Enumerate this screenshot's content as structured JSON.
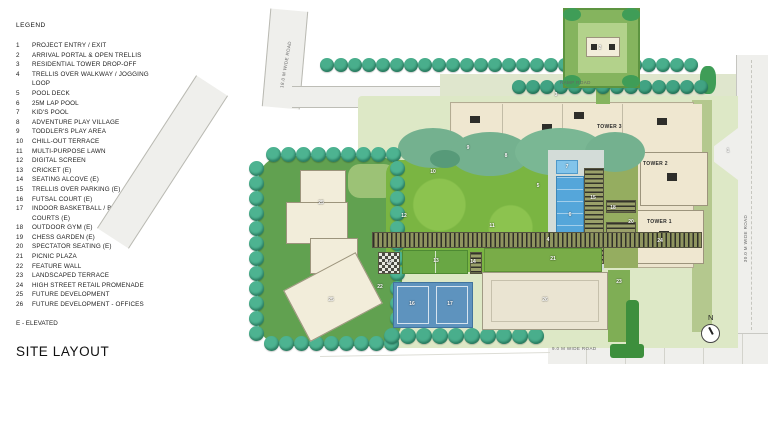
{
  "legend": {
    "title": "LEGEND",
    "items": [
      {
        "num": "1",
        "label": "PROJECT ENTRY / EXIT"
      },
      {
        "num": "2",
        "label": "ARRIVAL PORTAL & OPEN TRELLIS"
      },
      {
        "num": "3",
        "label": "RESIDENTIAL TOWER DROP-OFF"
      },
      {
        "num": "4",
        "label": "TRELLIS OVER WALKWAY / JOGGING LOOP"
      },
      {
        "num": "5",
        "label": "POOL DECK"
      },
      {
        "num": "6",
        "label": "25M LAP POOL"
      },
      {
        "num": "7",
        "label": "KID'S POOL"
      },
      {
        "num": "8",
        "label": "ADVENTURE PLAY VILLAGE"
      },
      {
        "num": "9",
        "label": "TODDLER'S PLAY AREA"
      },
      {
        "num": "10",
        "label": "CHILL-OUT TERRACE"
      },
      {
        "num": "11",
        "label": "MULTI-PURPOSE LAWN"
      },
      {
        "num": "12",
        "label": "DIGITAL SCREEN"
      },
      {
        "num": "13",
        "label": "CRICKET (E)"
      },
      {
        "num": "14",
        "label": "SEATING ALCOVE (E)"
      },
      {
        "num": "15",
        "label": "TRELLIS OVER PARKING (E)"
      },
      {
        "num": "16",
        "label": "FUTSAL COURT (E)"
      },
      {
        "num": "17",
        "label": "INDOOR BASKETBALL / BADMINTON COURTS (E)"
      },
      {
        "num": "18",
        "label": "OUTDOOR GYM (E)"
      },
      {
        "num": "19",
        "label": "CHESS GARDEN (E)"
      },
      {
        "num": "20",
        "label": "SPECTATOR SEATING (E)"
      },
      {
        "num": "21",
        "label": "PICNIC PLAZA"
      },
      {
        "num": "22",
        "label": "FEATURE WALL"
      },
      {
        "num": "23",
        "label": "LANDSCAPED TERRACE"
      },
      {
        "num": "24",
        "label": "HIGH STREET RETAIL PROMENADE"
      },
      {
        "num": "25",
        "label": "FUTURE DEVELOPMENT"
      },
      {
        "num": "26",
        "label": "FUTURE DEVELOPMENT - OFFICES"
      }
    ],
    "note": "E - ELEVATED"
  },
  "page_title": "SITE LAYOUT",
  "map": {
    "north_label": "N",
    "tower_labels": [
      {
        "text": "TOWER 3",
        "x": 597,
        "y": 124
      },
      {
        "text": "TOWER 2",
        "x": 643,
        "y": 161
      },
      {
        "text": "TOWER 1",
        "x": 647,
        "y": 219
      }
    ],
    "road_labels": [
      {
        "text": "18.0 M WIDE ROAD",
        "x": 262,
        "y": 62,
        "rot": -80
      },
      {
        "text": "RAMP ROAD",
        "x": 560,
        "y": 80,
        "rot": 0
      },
      {
        "text": "30.0 M WIDE ROAD",
        "x": 722,
        "y": 236,
        "rot": -90
      },
      {
        "text": "9.0 M WIDE ROAD",
        "x": 552,
        "y": 346,
        "rot": 0
      }
    ],
    "markers": [
      {
        "n": "1",
        "x": 728,
        "y": 151
      },
      {
        "n": "2",
        "x": 600,
        "y": 48
      },
      {
        "n": "3",
        "x": 556,
        "y": 95
      },
      {
        "n": "4",
        "x": 548,
        "y": 240
      },
      {
        "n": "5",
        "x": 538,
        "y": 186
      },
      {
        "n": "6",
        "x": 570,
        "y": 215
      },
      {
        "n": "7",
        "x": 567,
        "y": 167
      },
      {
        "n": "8",
        "x": 506,
        "y": 156
      },
      {
        "n": "9",
        "x": 468,
        "y": 148
      },
      {
        "n": "10",
        "x": 433,
        "y": 172
      },
      {
        "n": "11",
        "x": 492,
        "y": 226
      },
      {
        "n": "12",
        "x": 404,
        "y": 216
      },
      {
        "n": "13",
        "x": 436,
        "y": 261
      },
      {
        "n": "14",
        "x": 473,
        "y": 262
      },
      {
        "n": "15",
        "x": 593,
        "y": 198
      },
      {
        "n": "16",
        "x": 412,
        "y": 304
      },
      {
        "n": "17",
        "x": 450,
        "y": 304
      },
      {
        "n": "18",
        "x": 613,
        "y": 208
      },
      {
        "n": "19",
        "x": 389,
        "y": 263
      },
      {
        "n": "20",
        "x": 631,
        "y": 222
      },
      {
        "n": "21",
        "x": 553,
        "y": 259
      },
      {
        "n": "22",
        "x": 380,
        "y": 287
      },
      {
        "n": "23",
        "x": 619,
        "y": 282
      },
      {
        "n": "24",
        "x": 660,
        "y": 241
      },
      {
        "n": "25",
        "x": 321,
        "y": 203
      },
      {
        "n": "25",
        "x": 331,
        "y": 300
      },
      {
        "n": "26",
        "x": 545,
        "y": 300
      }
    ],
    "tree_rows": [
      {
        "x": 320,
        "y": 58,
        "n": 27,
        "dx": 14,
        "dy": 0,
        "d": 14,
        "c": "#49ae8c"
      },
      {
        "x": 512,
        "y": 80,
        "n": 14,
        "dx": 14,
        "dy": 0,
        "d": 14,
        "c": "#41a383"
      },
      {
        "x": 266,
        "y": 147,
        "n": 9,
        "dx": 15,
        "dy": 0,
        "d": 15,
        "c": "#4db391"
      },
      {
        "x": 264,
        "y": 336,
        "n": 9,
        "dx": 15,
        "dy": 0,
        "d": 15,
        "c": "#4db391"
      },
      {
        "x": 249,
        "y": 161,
        "n": 12,
        "dx": 0,
        "dy": 15,
        "d": 15,
        "c": "#4db391"
      },
      {
        "x": 390,
        "y": 161,
        "n": 11,
        "dx": 0,
        "dy": 15,
        "d": 15,
        "c": "#4db391"
      },
      {
        "x": 384,
        "y": 328,
        "n": 10,
        "dx": 16,
        "dy": 0,
        "d": 16,
        "c": "#49ae8c"
      }
    ],
    "colors": {
      "terrace": "#dde8c6",
      "lawn": "#7ab542",
      "cluster_green": "#61a150",
      "pool_blue": "#55a6da",
      "court_blue": "#5e93be",
      "building_beige": "#ece4cd",
      "tree_teal": "#49ae8c",
      "dark_green": "#3d8f3d",
      "road_gray": "#efefec"
    }
  }
}
